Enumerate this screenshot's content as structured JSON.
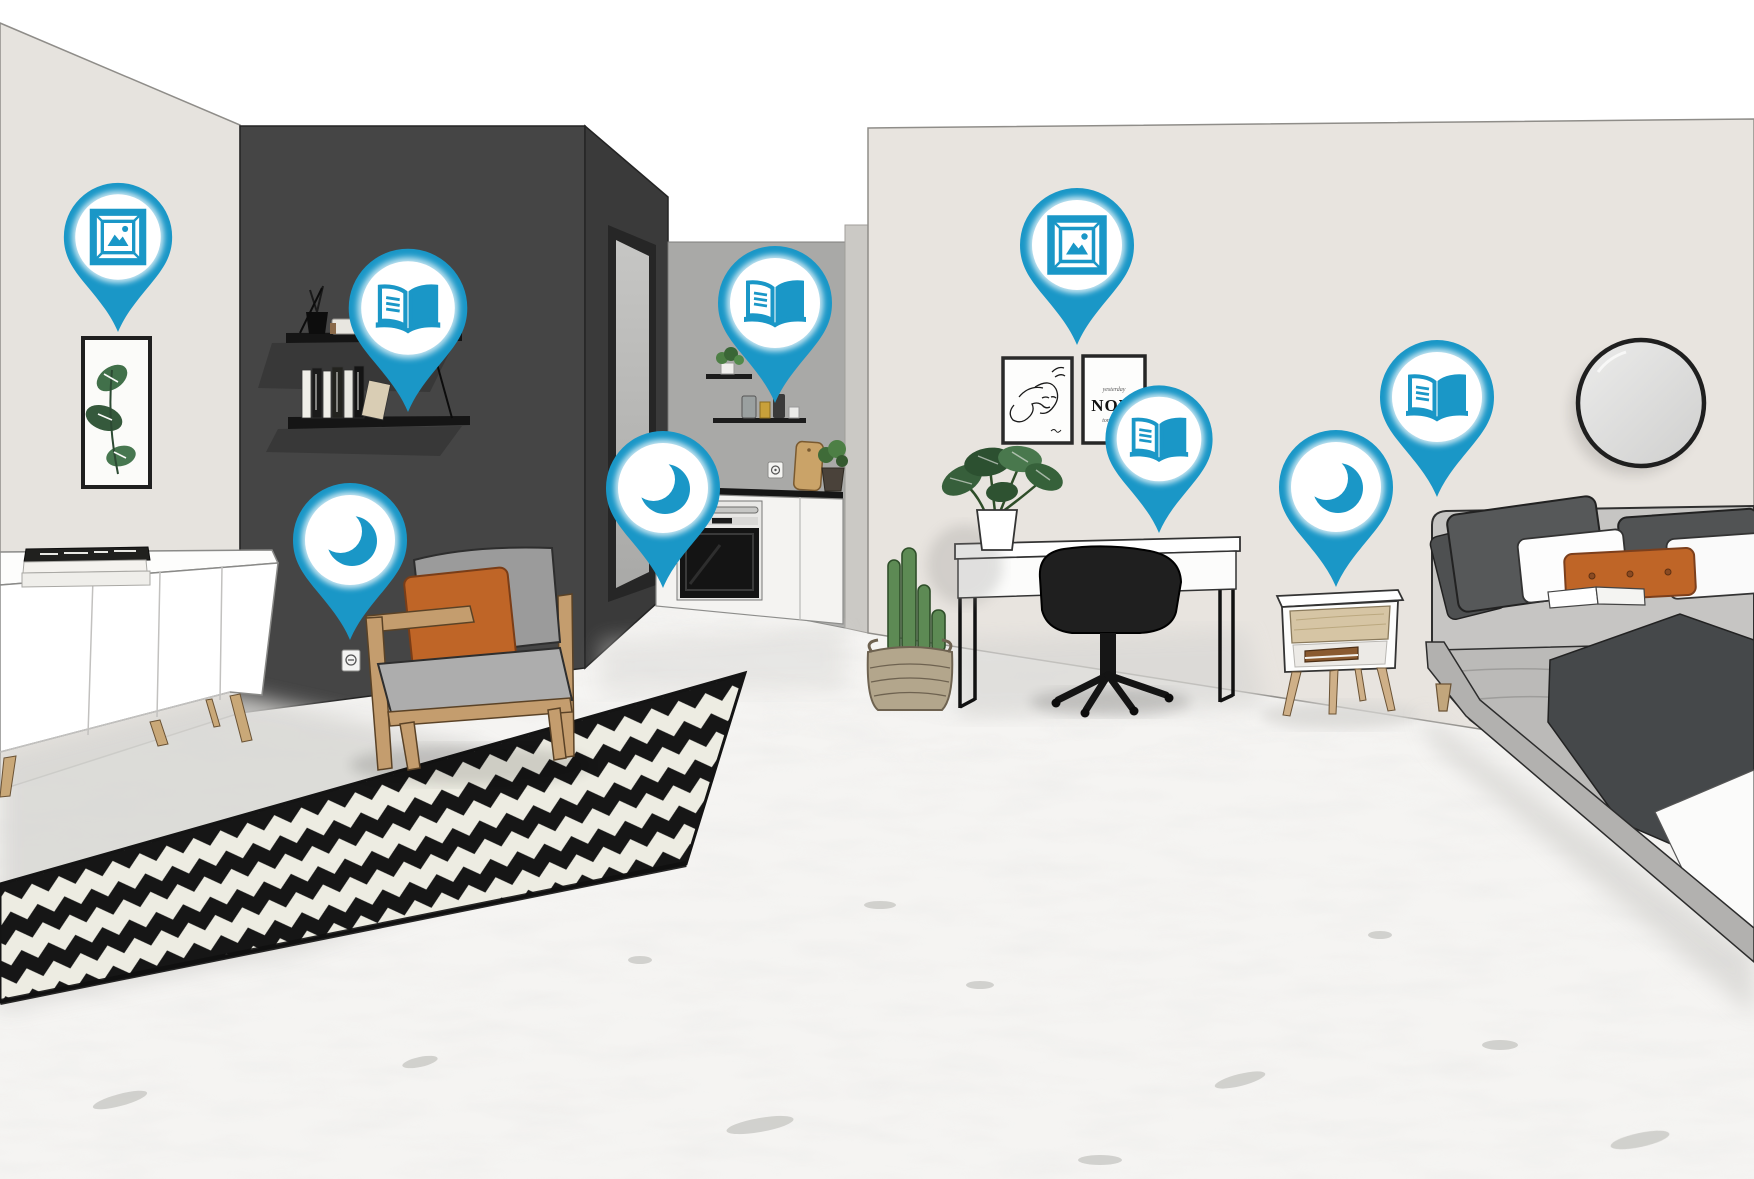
{
  "scene": {
    "type": "3d-room-render-with-hotspots",
    "areas": [
      "living-area",
      "kitchen-nook",
      "desk-area",
      "bedroom-area"
    ]
  },
  "colors": {
    "pin": "#1a97c7",
    "accent_orange": "#bf6527",
    "wall_dark": "#454545",
    "rug_black": "#161616",
    "rug_cream": "#edece2"
  },
  "poster": {
    "top": "yesterday",
    "main": "NOW",
    "bottom": "tomorrow"
  },
  "pins": [
    {
      "id": "pin-picture-art-left",
      "icon": "picture-frame-icon",
      "x": 118,
      "y": 332,
      "scale": 0.95
    },
    {
      "id": "pin-book-shelf",
      "icon": "open-book-icon",
      "x": 408,
      "y": 412,
      "scale": 1.04
    },
    {
      "id": "pin-moon-armchair",
      "icon": "moon-icon",
      "x": 350,
      "y": 640,
      "scale": 1
    },
    {
      "id": "pin-moon-kitchen",
      "icon": "moon-icon",
      "x": 663,
      "y": 588,
      "scale": 1
    },
    {
      "id": "pin-book-kitchen",
      "icon": "open-book-icon",
      "x": 775,
      "y": 403,
      "scale": 1
    },
    {
      "id": "pin-picture-art-desk",
      "icon": "picture-frame-icon",
      "x": 1077,
      "y": 345,
      "scale": 1
    },
    {
      "id": "pin-book-desk",
      "icon": "open-book-icon",
      "x": 1159,
      "y": 533,
      "scale": 0.94
    },
    {
      "id": "pin-moon-nightstand",
      "icon": "moon-icon",
      "x": 1336,
      "y": 587,
      "scale": 1
    },
    {
      "id": "pin-book-bed",
      "icon": "open-book-icon",
      "x": 1437,
      "y": 497,
      "scale": 1
    }
  ]
}
